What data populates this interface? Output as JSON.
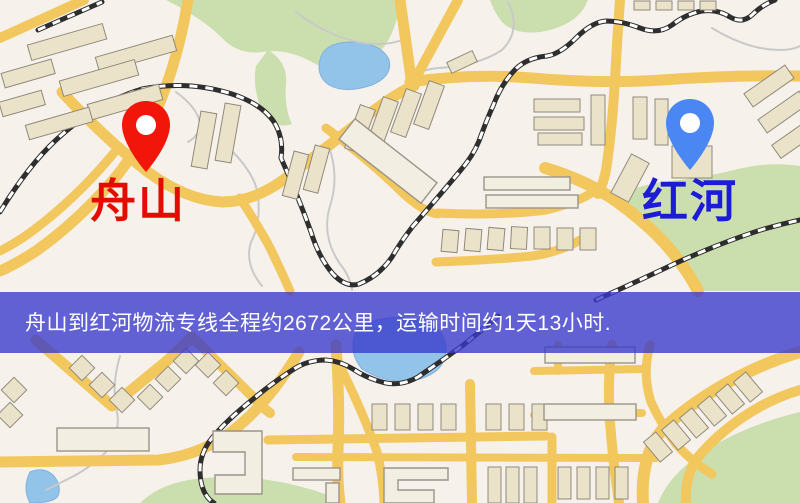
{
  "origin": {
    "label": "舟山",
    "pin_color": "#f2150a",
    "label_color": "#e50b00"
  },
  "destination": {
    "label": "红河",
    "pin_color": "#4a87f2",
    "label_color": "#1c1cd6"
  },
  "banner": {
    "text": "舟山到红河物流专线全程约2672公里，运输时间约1天13小时.",
    "background_rgba": "rgba(56,56,204,0.78)",
    "text_color": "#ffffff"
  },
  "route": {
    "from": "舟山",
    "to": "红河",
    "distance_km": 2672,
    "duration": "1天13小时"
  },
  "map_colors": {
    "background": "#f7f1ec",
    "road": "#f2c75e",
    "building_fill": "#ebe3c9",
    "building_outline": "#8f897b",
    "green_area": "#cbdfae",
    "water": "#92c3e9",
    "railway": "#2e2e2e"
  }
}
